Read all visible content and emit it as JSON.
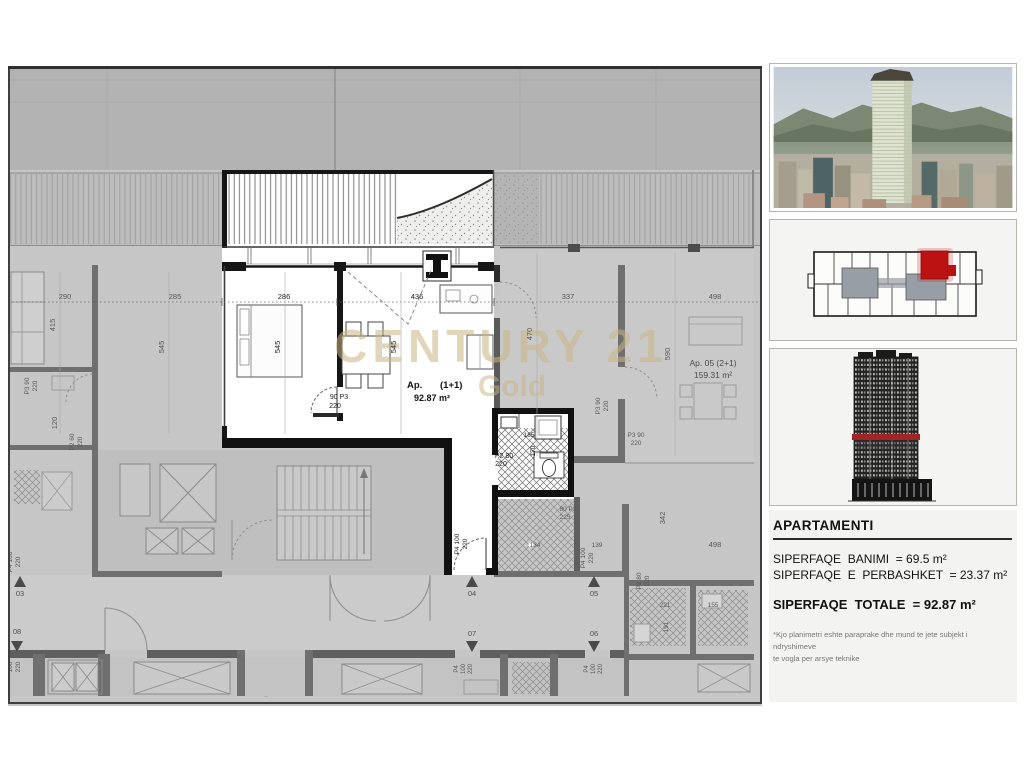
{
  "watermark": {
    "line1": "CENTURY 21",
    "line2": "Gold",
    "color": "#c9b483"
  },
  "plan": {
    "apartment": {
      "prefix": "Ap.",
      "suffix": "(1+1)",
      "area": "92.87 m²"
    },
    "neighbor": {
      "name": "Ap. 05 (2+1)",
      "area": "159.31 m²"
    },
    "labels": [
      {
        "t": "286",
        "x": 276,
        "y": 233,
        "c": "d"
      },
      {
        "t": "436",
        "x": 409,
        "y": 233,
        "c": "d"
      },
      {
        "t": "545",
        "x": 272,
        "y": 281,
        "r": -90,
        "c": "d"
      },
      {
        "t": "545",
        "x": 388,
        "y": 281,
        "r": -90,
        "c": "d"
      },
      {
        "t": "90  P3",
        "x": 331,
        "y": 333,
        "c": "d",
        "s": 7
      },
      {
        "t": "220",
        "x": 327,
        "y": 342,
        "c": "d",
        "s": 7
      },
      {
        "t": "185",
        "x": 521,
        "y": 371,
        "c": "d",
        "s": 6.5
      },
      {
        "t": "170",
        "x": 527,
        "y": 385,
        "r": -90,
        "c": "d",
        "s": 6.5
      },
      {
        "t": "P2  80",
        "x": 496,
        "y": 392,
        "c": "d",
        "s": 7
      },
      {
        "t": "220",
        "x": 493,
        "y": 400,
        "c": "d",
        "s": 7
      },
      {
        "t": "P4 100",
        "x": 451,
        "y": 478,
        "r": -90,
        "c": "d",
        "s": 6.5
      },
      {
        "t": "220",
        "x": 459,
        "y": 478,
        "r": -90,
        "c": "d",
        "s": 6.5
      },
      {
        "t": "290",
        "x": 57,
        "y": 233
      },
      {
        "t": "415",
        "x": 47,
        "y": 259,
        "r": -90
      },
      {
        "t": "285",
        "x": 167,
        "y": 233
      },
      {
        "t": "545",
        "x": 156,
        "y": 281,
        "r": -90
      },
      {
        "t": "P3 90",
        "x": 21,
        "y": 320,
        "r": -90,
        "s": 6.5
      },
      {
        "t": "220",
        "x": 29,
        "y": 320,
        "r": -90,
        "s": 6.5
      },
      {
        "t": "120",
        "x": 49,
        "y": 357,
        "r": -90
      },
      {
        "t": "P2 60",
        "x": 66,
        "y": 376,
        "r": -90,
        "s": 6.5
      },
      {
        "t": "220",
        "x": 74,
        "y": 376,
        "r": -90,
        "s": 6.5
      },
      {
        "t": "337",
        "x": 560,
        "y": 233
      },
      {
        "t": "498",
        "x": 707,
        "y": 233
      },
      {
        "t": "470",
        "x": 524,
        "y": 268,
        "r": -90
      },
      {
        "t": "590",
        "x": 662,
        "y": 288,
        "r": -90
      },
      {
        "t": "P3 90",
        "x": 592,
        "y": 340,
        "r": -90,
        "s": 6.5
      },
      {
        "t": "220",
        "x": 600,
        "y": 340,
        "r": -90,
        "s": 6.5
      },
      {
        "t": "P3  90",
        "x": 628,
        "y": 371,
        "s": 6.5
      },
      {
        "t": "220",
        "x": 628,
        "y": 379,
        "s": 6.5
      },
      {
        "t": "80  P2",
        "x": 560,
        "y": 445,
        "s": 6.5
      },
      {
        "t": "225",
        "x": 557,
        "y": 453,
        "s": 6.5
      },
      {
        "t": "134",
        "x": 527,
        "y": 481,
        "s": 6.5
      },
      {
        "t": "139",
        "x": 589,
        "y": 481,
        "s": 6.5
      },
      {
        "t": "P4 100",
        "x": 577,
        "y": 492,
        "r": -90,
        "s": 6.5
      },
      {
        "t": "220",
        "x": 585,
        "y": 492,
        "r": -90,
        "s": 6.5
      },
      {
        "t": "342",
        "x": 657,
        "y": 452,
        "r": -90
      },
      {
        "t": "498",
        "x": 707,
        "y": 481
      },
      {
        "t": "P2 80",
        "x": 633,
        "y": 515,
        "r": -90,
        "s": 6.5
      },
      {
        "t": "220",
        "x": 641,
        "y": 515,
        "r": -90,
        "s": 6.5
      },
      {
        "t": "221",
        "x": 657,
        "y": 541,
        "s": 6.5
      },
      {
        "t": "155",
        "x": 705,
        "y": 541,
        "s": 6.5
      },
      {
        "t": "191",
        "x": 660,
        "y": 561,
        "r": -90,
        "s": 6.5
      },
      {
        "t": "P4 100",
        "x": 4,
        "y": 496,
        "r": -90,
        "s": 6.5
      },
      {
        "t": "220",
        "x": 12,
        "y": 496,
        "r": -90,
        "s": 6.5
      },
      {
        "t": "100",
        "x": 4,
        "y": 601,
        "r": -90,
        "s": 6.5
      },
      {
        "t": "220",
        "x": 12,
        "y": 601,
        "r": -90,
        "s": 6.5
      },
      {
        "t": "P4",
        "x": 450,
        "y": 603,
        "r": -90,
        "s": 6
      },
      {
        "t": "100",
        "x": 457,
        "y": 603,
        "r": -90,
        "s": 6
      },
      {
        "t": "220",
        "x": 464,
        "y": 603,
        "r": -90,
        "s": 6
      },
      {
        "t": "P4",
        "x": 580,
        "y": 603,
        "r": -90,
        "s": 6
      },
      {
        "t": "100",
        "x": 587,
        "y": 603,
        "r": -90,
        "s": 6
      },
      {
        "t": "220",
        "x": 594,
        "y": 603,
        "r": -90,
        "s": 6
      }
    ],
    "markers": [
      {
        "t": "04",
        "x": 464,
        "y": 530,
        "d": "up"
      },
      {
        "t": "05",
        "x": 586,
        "y": 530,
        "d": "up"
      },
      {
        "t": "03",
        "x": 12,
        "y": 530,
        "d": "up"
      },
      {
        "t": "07",
        "x": 464,
        "y": 570,
        "d": "down"
      },
      {
        "t": "06",
        "x": 586,
        "y": 570,
        "d": "down"
      },
      {
        "t": "08",
        "x": 9,
        "y": 568,
        "d": "down"
      }
    ]
  },
  "sidebar": {
    "info": {
      "heading": "APARTAMENTI",
      "line1": "SIPERFAQE  BANIMI  = 69.5 m²",
      "line2": "SIPERFAQE  E  PERBASHKET  = 23.37 m²",
      "total": "SIPERFAQE  TOTALE  = 92.87 m²",
      "note1": "*Kjo planimetri eshte paraprake dhe mund te jete subjekt i ndryshimeve",
      "note2": "te vogla per arsye teknike"
    }
  },
  "colors": {
    "accent_red": "#bd1212",
    "elevation_band": "#a32424",
    "watermark": "#c9b483"
  }
}
